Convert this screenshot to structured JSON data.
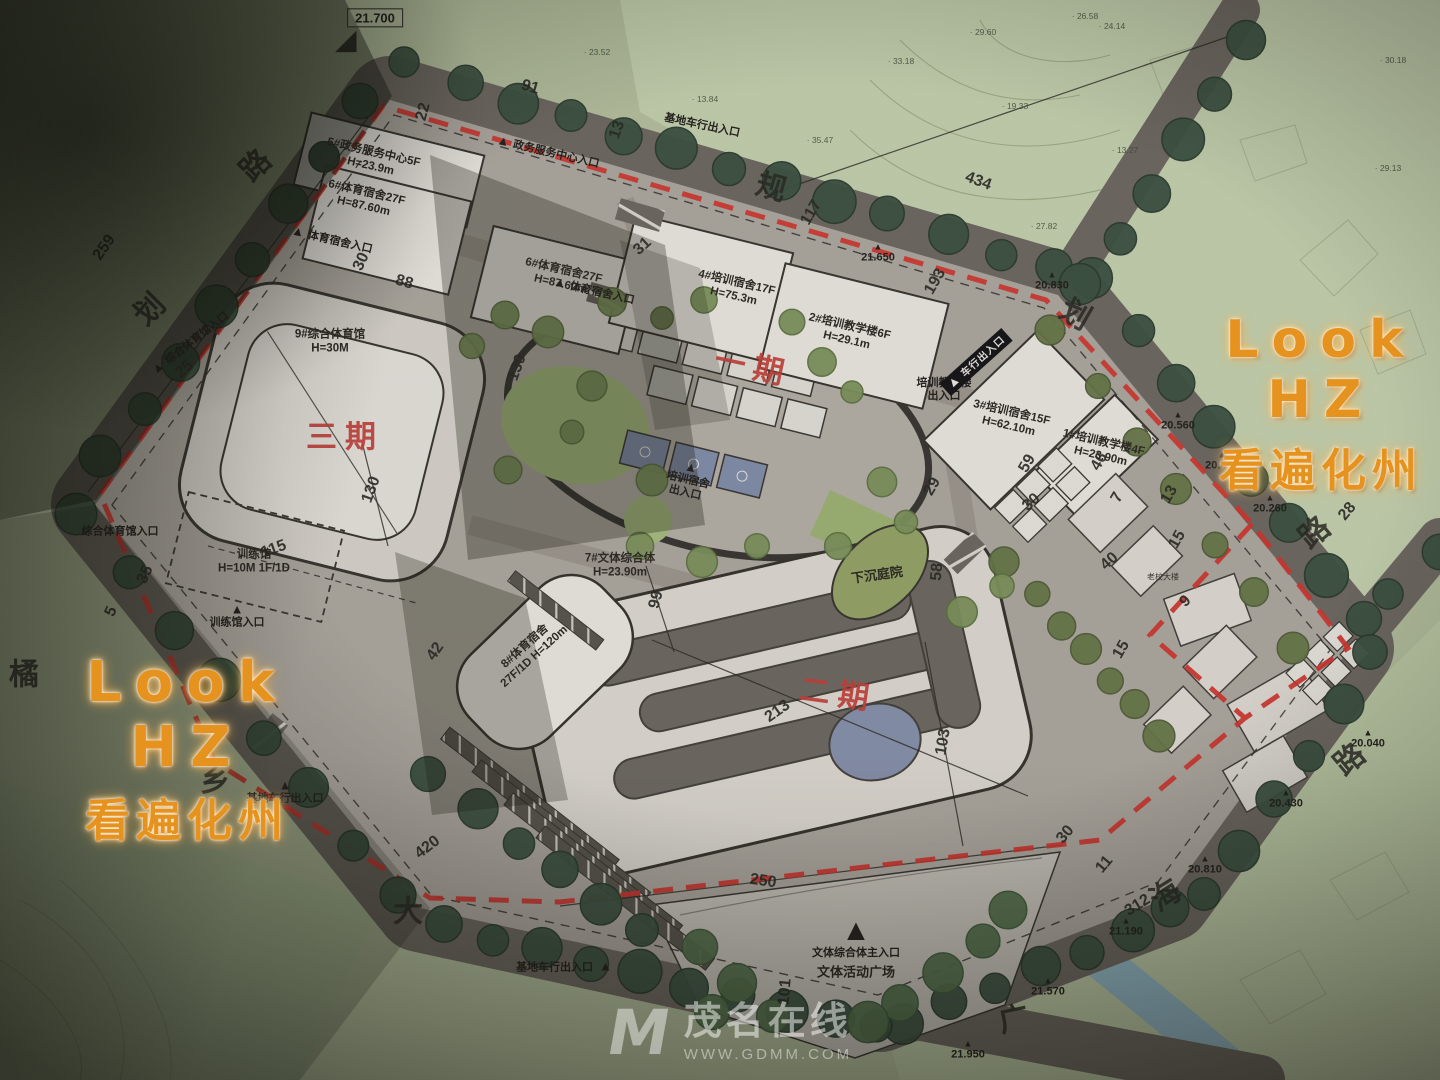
{
  "watermarks": {
    "right": {
      "line1": "Look HZ",
      "line2": "看遍化州"
    },
    "left": {
      "line1": "Look HZ",
      "line2": "看遍化州"
    },
    "footer": {
      "logo": "M",
      "site_name": "茂名在线",
      "site_url": "WWW.GDMM.COM"
    }
  },
  "colors": {
    "phase_red": "#c2413c",
    "boundary_red": "#cf3630",
    "watermark_orange": "#e6921e",
    "field_green": "#b4bf9e",
    "road_gray": "#6e6862",
    "building_white": "#e9e6e0",
    "court_blue": "#828da9"
  },
  "phases": [
    {
      "text": "三期",
      "x": 345,
      "y": 438,
      "rot": 0
    },
    {
      "text": "一期",
      "x": 753,
      "y": 368,
      "rot": 12
    },
    {
      "text": "二期",
      "x": 838,
      "y": 695,
      "rot": 8
    }
  ],
  "buildings": [
    {
      "name": "5#政务服务中心5F",
      "height": "H=23.9m",
      "x": 372,
      "y": 160,
      "rot": 13
    },
    {
      "name": "6#体育宿舍27F",
      "height": "H=87.60m",
      "x": 365,
      "y": 200,
      "rot": 13
    },
    {
      "name": "6#体育宿舍27F",
      "height": "H=87.60m",
      "x": 562,
      "y": 278,
      "rot": 13
    },
    {
      "name": "4#培训宿舍17F",
      "height": "H=75.3m",
      "x": 735,
      "y": 290,
      "rot": 13
    },
    {
      "name": "2#培训教学楼6F",
      "height": "H=29.1m",
      "x": 848,
      "y": 334,
      "rot": 13
    },
    {
      "name": "3#培训宿舍15F",
      "height": "H=62.10m",
      "x": 1010,
      "y": 420,
      "rot": 13
    },
    {
      "name": "1#培训教学楼4F",
      "height": "H=23.90m",
      "x": 1102,
      "y": 450,
      "rot": 13
    },
    {
      "name": "9#综合体育馆",
      "height": "H=30M",
      "x": 330,
      "y": 342,
      "rot": 0
    },
    {
      "name": "训练馆",
      "height": "H=10M 1F/1D",
      "x": 254,
      "y": 562,
      "rot": 0
    },
    {
      "name": "7#文体综合体",
      "height": "H=23.90m",
      "x": 620,
      "y": 566,
      "rot": 0
    },
    {
      "name": "8#体育宿舍",
      "height": "27F/1D H=120m",
      "x": 530,
      "y": 652,
      "rot": -42
    },
    {
      "name": "老校大楼",
      "height": "",
      "x": 1163,
      "y": 577,
      "rot": 0,
      "small": true
    }
  ],
  "entrances": [
    {
      "text": "政务服务中心入口",
      "x": 548,
      "y": 152,
      "rot": 13,
      "tri": "left"
    },
    {
      "text": "基地车行出入口",
      "x": 702,
      "y": 126,
      "rot": 12,
      "tri": "none"
    },
    {
      "text": "体育宿舍入口",
      "x": 332,
      "y": 240,
      "rot": 13,
      "tri": "left"
    },
    {
      "text": "体育宿舍入口",
      "x": 594,
      "y": 291,
      "rot": 13,
      "tri": "left"
    },
    {
      "text": "培训宿舍\n出入口",
      "x": 688,
      "y": 480,
      "rot": 13,
      "tri": "above"
    },
    {
      "text": "培训教学楼\n出入口",
      "x": 944,
      "y": 390,
      "rot": 0,
      "tri": "none"
    },
    {
      "text": "车行出入口",
      "x": 976,
      "y": 362,
      "rot": -42,
      "tri": "left",
      "style": "dark"
    },
    {
      "text": "综合体育馆入口",
      "x": 190,
      "y": 343,
      "rot": -38,
      "tri": "left"
    },
    {
      "text": "综合体育馆入口",
      "x": 120,
      "y": 532,
      "rot": 0,
      "tri": "none"
    },
    {
      "text": "训练馆入口",
      "x": 237,
      "y": 616,
      "rot": 0,
      "tri": "above"
    },
    {
      "text": "基地车行出入口",
      "x": 285,
      "y": 792,
      "rot": 0,
      "tri": "above"
    },
    {
      "text": "基地车行出入口",
      "x": 564,
      "y": 967,
      "rot": 0,
      "tri": "right"
    },
    {
      "text": "文体综合体主入口",
      "x": 856,
      "y": 938,
      "rot": 0,
      "tri": "above",
      "tsize": 30
    }
  ],
  "areas": [
    {
      "text": "下沉庭院",
      "x": 877,
      "y": 575,
      "rot": -8
    },
    {
      "text": "文体活动广场",
      "x": 856,
      "y": 972,
      "rot": 0
    }
  ],
  "road_chars": [
    {
      "text": "路",
      "x": 256,
      "y": 166,
      "rot": -45
    },
    {
      "text": "划",
      "x": 150,
      "y": 310,
      "rot": -45
    },
    {
      "text": "橘",
      "x": 24,
      "y": 675,
      "rot": 0
    },
    {
      "text": "乡",
      "x": 215,
      "y": 782,
      "rot": 0
    },
    {
      "text": "大",
      "x": 408,
      "y": 912,
      "rot": 0
    },
    {
      "text": "海",
      "x": 1166,
      "y": 896,
      "rot": -32
    },
    {
      "text": "广",
      "x": 1014,
      "y": 1020,
      "rot": -12
    },
    {
      "text": "规",
      "x": 771,
      "y": 188,
      "rot": 16
    },
    {
      "text": "划",
      "x": 1075,
      "y": 315,
      "rot": 30
    },
    {
      "text": "路",
      "x": 1315,
      "y": 533,
      "rot": -40
    },
    {
      "text": "路",
      "x": 1350,
      "y": 760,
      "rot": -40
    }
  ],
  "dimensions": [
    {
      "text": "259",
      "x": 105,
      "y": 248,
      "rot": -55
    },
    {
      "text": "22",
      "x": 424,
      "y": 112,
      "rot": -75
    },
    {
      "text": "91",
      "x": 530,
      "y": 88,
      "rot": 16
    },
    {
      "text": "13",
      "x": 618,
      "y": 130,
      "rot": -70
    },
    {
      "text": "434",
      "x": 978,
      "y": 182,
      "rot": 20
    },
    {
      "text": "117",
      "x": 812,
      "y": 213,
      "rot": -60
    },
    {
      "text": "193",
      "x": 936,
      "y": 282,
      "rot": -60
    },
    {
      "text": "31",
      "x": 643,
      "y": 247,
      "rot": -42
    },
    {
      "text": "30",
      "x": 362,
      "y": 262,
      "rot": -65
    },
    {
      "text": "88",
      "x": 404,
      "y": 283,
      "rot": 16
    },
    {
      "text": "25",
      "x": 185,
      "y": 370,
      "rot": -42
    },
    {
      "text": "130",
      "x": 518,
      "y": 368,
      "rot": -70
    },
    {
      "text": "130",
      "x": 372,
      "y": 490,
      "rot": -70
    },
    {
      "text": "115",
      "x": 274,
      "y": 550,
      "rot": -20
    },
    {
      "text": "35",
      "x": 146,
      "y": 575,
      "rot": -65
    },
    {
      "text": "5",
      "x": 112,
      "y": 612,
      "rot": -65
    },
    {
      "text": "42",
      "x": 436,
      "y": 652,
      "rot": -55
    },
    {
      "text": "99",
      "x": 657,
      "y": 600,
      "rot": -75
    },
    {
      "text": "213",
      "x": 778,
      "y": 712,
      "rot": -35
    },
    {
      "text": "103",
      "x": 944,
      "y": 742,
      "rot": -80
    },
    {
      "text": "58",
      "x": 938,
      "y": 572,
      "rot": -85
    },
    {
      "text": "29",
      "x": 933,
      "y": 487,
      "rot": -60
    },
    {
      "text": "30",
      "x": 1032,
      "y": 503,
      "rot": -42
    },
    {
      "text": "59",
      "x": 1028,
      "y": 464,
      "rot": -60
    },
    {
      "text": "46",
      "x": 1100,
      "y": 462,
      "rot": -60
    },
    {
      "text": "7",
      "x": 1118,
      "y": 498,
      "rot": -60
    },
    {
      "text": "13",
      "x": 1170,
      "y": 495,
      "rot": -60
    },
    {
      "text": "15",
      "x": 1178,
      "y": 540,
      "rot": -60
    },
    {
      "text": "40",
      "x": 1110,
      "y": 562,
      "rot": -42
    },
    {
      "text": "9",
      "x": 1186,
      "y": 602,
      "rot": -42
    },
    {
      "text": "15",
      "x": 1122,
      "y": 650,
      "rot": -60
    },
    {
      "text": "28",
      "x": 1348,
      "y": 512,
      "rot": -50
    },
    {
      "text": "30",
      "x": 1066,
      "y": 835,
      "rot": -50
    },
    {
      "text": "11",
      "x": 1105,
      "y": 865,
      "rot": -50
    },
    {
      "text": "250",
      "x": 763,
      "y": 882,
      "rot": 8
    },
    {
      "text": "101",
      "x": 786,
      "y": 992,
      "rot": -85
    },
    {
      "text": "420",
      "x": 428,
      "y": 848,
      "rot": -38
    },
    {
      "text": "312",
      "x": 1138,
      "y": 906,
      "rot": -32
    }
  ],
  "elevations": [
    {
      "text": "21.700",
      "x": 375,
      "y": 18,
      "boxed": true
    },
    {
      "text": "21.650",
      "x": 878,
      "y": 254
    },
    {
      "text": "20.830",
      "x": 1052,
      "y": 282
    },
    {
      "text": "20.560",
      "x": 1178,
      "y": 422
    },
    {
      "text": "20.410",
      "x": 1222,
      "y": 462
    },
    {
      "text": "20.260",
      "x": 1270,
      "y": 505
    },
    {
      "text": "20.040",
      "x": 1368,
      "y": 740
    },
    {
      "text": "20.430",
      "x": 1286,
      "y": 800
    },
    {
      "text": "20.810",
      "x": 1205,
      "y": 866
    },
    {
      "text": "21.190",
      "x": 1126,
      "y": 928
    },
    {
      "text": "21.570",
      "x": 1048,
      "y": 988
    },
    {
      "text": "21.950",
      "x": 968,
      "y": 1051
    }
  ],
  "spot_heights": [
    {
      "text": "26.58",
      "x": 1085,
      "y": 16
    },
    {
      "text": "23.52",
      "x": 597,
      "y": 52
    },
    {
      "text": "13.84",
      "x": 705,
      "y": 99
    },
    {
      "text": "29.60",
      "x": 983,
      "y": 32
    },
    {
      "text": "24.14",
      "x": 1112,
      "y": 26
    },
    {
      "text": "33.18",
      "x": 901,
      "y": 61
    },
    {
      "text": "19.33",
      "x": 1015,
      "y": 106
    },
    {
      "text": "13.27",
      "x": 1125,
      "y": 150
    },
    {
      "text": "27.82",
      "x": 1044,
      "y": 226
    },
    {
      "text": "35.47",
      "x": 820,
      "y": 140
    },
    {
      "text": "30.18",
      "x": 1393,
      "y": 60
    },
    {
      "text": "29.13",
      "x": 1388,
      "y": 168
    }
  ]
}
